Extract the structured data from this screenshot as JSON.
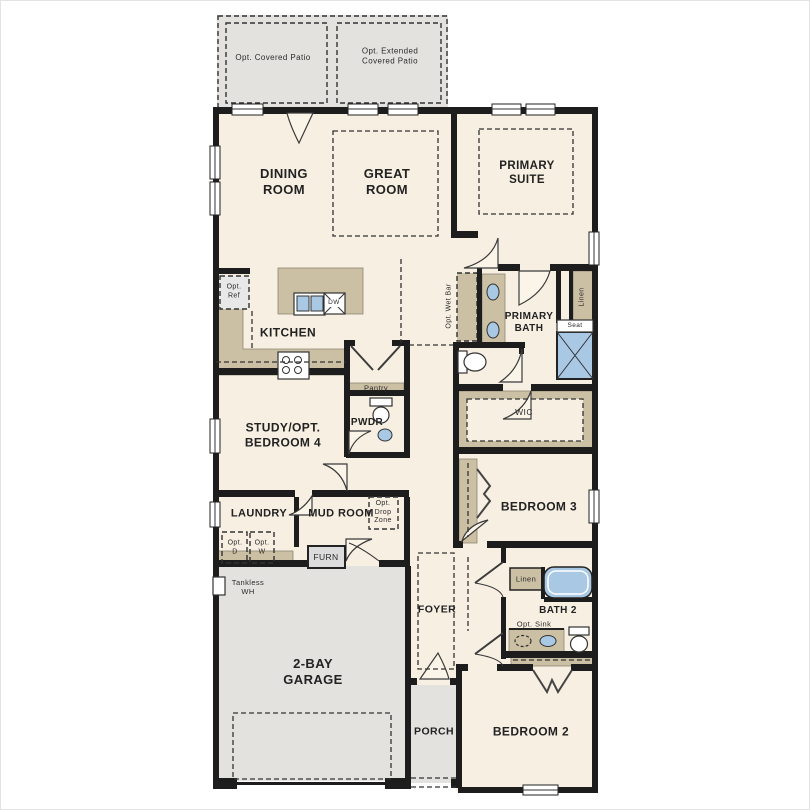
{
  "plan": {
    "colors": {
      "cream": "#f7efe2",
      "tan": "#cbbfa4",
      "gray": "#e3e2df",
      "wall": "#1d1d1d",
      "blue": "#a9c8e4"
    },
    "patios": {
      "covered": "Opt. Covered Patio",
      "extended": "Opt. Extended\nCovered Patio"
    },
    "rooms": {
      "dining": "DINING\nROOM",
      "great": "GREAT\nROOM",
      "primary_suite": "PRIMARY\nSUITE",
      "kitchen": "KITCHEN",
      "primary_bath": "PRIMARY\nBATH",
      "wic": "WIC",
      "study": "STUDY/OPT.\nBEDROOM 4",
      "pwdr": "PWDR",
      "bedroom3": "BEDROOM 3",
      "laundry": "LAUNDRY",
      "mud_room": "MUD ROOM",
      "garage": "2-BAY\nGARAGE",
      "foyer": "FOYER",
      "porch": "PORCH",
      "bath2": "BATH 2",
      "bedroom2": "BEDROOM 2"
    },
    "features": {
      "opt_ref": "Opt.\nRef",
      "dw": "DW",
      "pantry": "Pantry",
      "opt_wet_bar": "Opt. Wet Bar",
      "linen_primary": "Linen",
      "seat": "Seat",
      "opt_d": "Opt.\nD",
      "opt_w": "Opt.\nW",
      "opt_drop_zone": "Opt.\nDrop\nZone",
      "furn": "FURN",
      "tankless_wh": "Tankless\nWH",
      "linen_bath2": "Linen",
      "opt_sink": "Opt. Sink"
    }
  }
}
